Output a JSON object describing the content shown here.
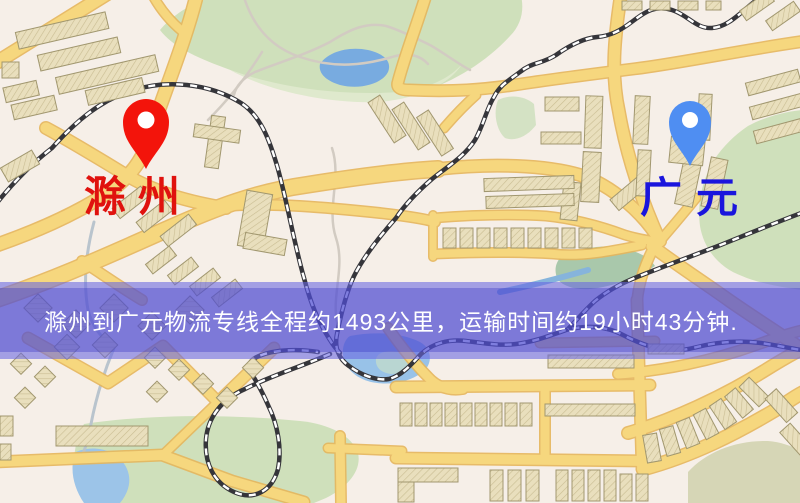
{
  "map": {
    "origin": {
      "name": "滁州",
      "label_color": "#e0120e",
      "pin_color": "#f3140b"
    },
    "destination": {
      "name": "广元",
      "label_color": "#1a15dd",
      "pin_color": "#4f8ef2"
    }
  },
  "banner": {
    "text": "滁州到广元物流专线全程约1493公里，运输时间约19小时43分钟.",
    "distance_km": "1493",
    "duration": "19小时43分钟",
    "text_color": "#ffffff",
    "overlay_color": "#6866e2"
  },
  "palette": {
    "background": "#f6efe8",
    "road": "#f6d77e",
    "road_casing": "#e6b65c",
    "park": "#cfe0bb",
    "water": "#98c2e8",
    "building": "#e9dfbd",
    "railway": "#35353a"
  }
}
